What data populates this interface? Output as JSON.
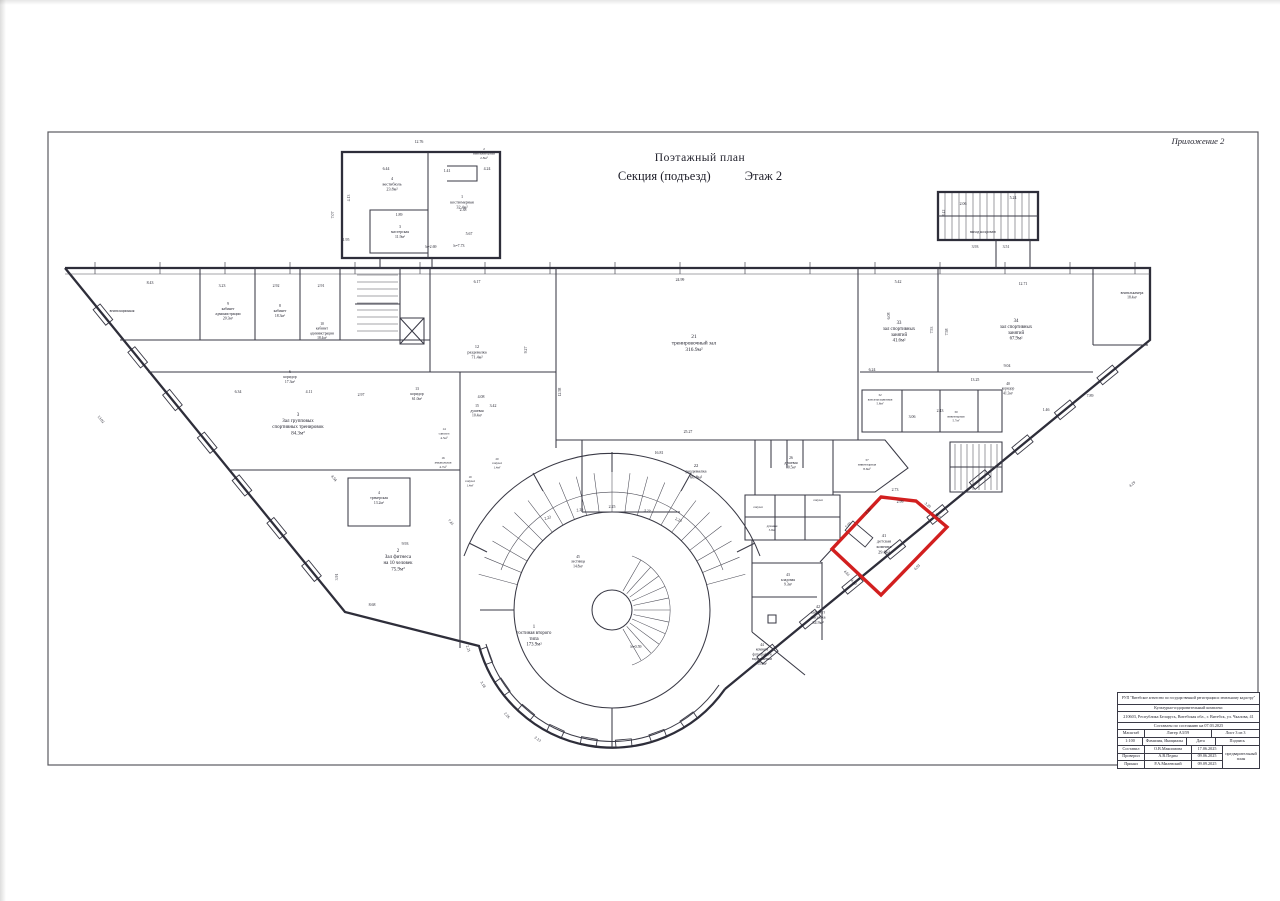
{
  "page": {
    "appendix": "Приложение 2",
    "title": "Поэтажный план",
    "subtitle": "Секция (подъезд)",
    "floor": "Этаж 2"
  },
  "plan": {
    "highlight_color": "#d21f1f",
    "rooms": [
      {
        "x": 392,
        "y": 180,
        "lines": [
          "4",
          "вестибюль",
          "23.8м²"
        ]
      },
      {
        "x": 484,
        "y": 150,
        "fs": 3.5,
        "lines": [
          "2",
          "вентиляторная",
          "2.8м²"
        ]
      },
      {
        "x": 462,
        "y": 198,
        "lines": [
          "1",
          "костюмерная",
          "32.4м²"
        ]
      },
      {
        "x": 400,
        "y": 228,
        "fs": 3.8,
        "lines": [
          "3",
          "мастерская",
          "11.9м²"
        ]
      },
      {
        "x": 122,
        "y": 312,
        "fs": 3.6,
        "lines": [
          "вентиляционная"
        ]
      },
      {
        "x": 228,
        "y": 305,
        "fs": 3.8,
        "lines": [
          "9",
          "кабинет",
          "администрации",
          "20.3м²"
        ]
      },
      {
        "x": 280,
        "y": 307,
        "fs": 3.8,
        "lines": [
          "8",
          "кабинет",
          "18.3м²"
        ]
      },
      {
        "x": 322,
        "y": 325,
        "fs": 3.6,
        "lines": [
          "10",
          "кабинет",
          "администрации",
          "18.4м²"
        ]
      },
      {
        "x": 477,
        "y": 348,
        "lines": [
          "12",
          "раздевалка",
          "71.4м²"
        ]
      },
      {
        "x": 290,
        "y": 373,
        "fs": 3.8,
        "lines": [
          "6",
          "коридор",
          "17.3м²"
        ]
      },
      {
        "x": 417,
        "y": 390,
        "fs": 3.8,
        "lines": [
          "13",
          "коридор",
          "61.0м²"
        ]
      },
      {
        "x": 298,
        "y": 416,
        "fs": 5,
        "lines": [
          "3",
          "Зал групповых",
          "спортивных тренировок",
          "84.3м²"
        ]
      },
      {
        "x": 477,
        "y": 407,
        "fs": 3.7,
        "lines": [
          "15",
          "душевая",
          "10.4м²"
        ]
      },
      {
        "x": 444,
        "y": 430,
        "fs": 3.3,
        "lines": [
          "14",
          "санузел",
          "4.5м²"
        ]
      },
      {
        "x": 443,
        "y": 459,
        "fs": 3.3,
        "lines": [
          "16",
          "умывальная",
          "4.7м²"
        ]
      },
      {
        "x": 470,
        "y": 478,
        "fs": 3.1,
        "lines": [
          "19",
          "санузел",
          "1.4м²"
        ]
      },
      {
        "x": 497,
        "y": 460,
        "fs": 3.1,
        "lines": [
          "20",
          "санузел",
          "1.4м²"
        ]
      },
      {
        "x": 379,
        "y": 494,
        "fs": 3.8,
        "lines": [
          "4",
          "тренерская",
          "13.2м²"
        ]
      },
      {
        "x": 398,
        "y": 552,
        "fs": 5,
        "lines": [
          "2",
          "Зал фитнеса",
          "на 10 человек",
          "75.9м²"
        ]
      },
      {
        "x": 694,
        "y": 338,
        "fs": 5.4,
        "lines": [
          "21",
          "тренировочный зал",
          "316.9м²"
        ]
      },
      {
        "x": 696,
        "y": 467,
        "fs": 4.6,
        "lines": [
          "22",
          "раздевалка",
          "60.8м²"
        ]
      },
      {
        "x": 791,
        "y": 459,
        "fs": 3.7,
        "lines": [
          "26",
          "душевая",
          "10.5м²"
        ]
      },
      {
        "x": 867,
        "y": 461,
        "fs": 3.4,
        "lines": [
          "37",
          "инвентарная",
          "8.6м²"
        ]
      },
      {
        "x": 758,
        "y": 508,
        "fs": 3,
        "lines": [
          "санузел"
        ]
      },
      {
        "x": 818,
        "y": 501,
        "fs": 3,
        "lines": [
          "санузел"
        ]
      },
      {
        "x": 772,
        "y": 527,
        "fs": 3,
        "lines": [
          "душевая",
          "3.9м²"
        ]
      },
      {
        "x": 880,
        "y": 396,
        "fs": 3.2,
        "lines": [
          "32",
          "консультационная",
          "5.8м²"
        ]
      },
      {
        "x": 956,
        "y": 413,
        "fs": 3.2,
        "lines": [
          "30",
          "инвентарная",
          "5.7м²"
        ]
      },
      {
        "x": 1008,
        "y": 385,
        "fs": 3.6,
        "lines": [
          "40",
          "коридор",
          "41.3м²"
        ]
      },
      {
        "x": 899,
        "y": 324,
        "fs": 4.8,
        "lines": [
          "33",
          "зал спортивных",
          "занятий",
          "41.6м²"
        ]
      },
      {
        "x": 1016,
        "y": 322,
        "fs": 4.8,
        "lines": [
          "34",
          "зал спортивных",
          "занятий",
          "67.9м²"
        ]
      },
      {
        "x": 1132,
        "y": 294,
        "fs": 3.6,
        "lines": [
          "вентилькамера",
          "18.4м²"
        ]
      },
      {
        "x": 983,
        "y": 233,
        "fs": 3.6,
        "lines": [
          "выход на кровлю"
        ]
      },
      {
        "x": 578,
        "y": 558,
        "fs": 3.6,
        "lines": [
          "45",
          "лестница",
          "14.8м²"
        ]
      },
      {
        "x": 534,
        "y": 628,
        "fs": 4.8,
        "lines": [
          "1",
          "гостиная второго",
          "типа",
          "173.9м²"
        ]
      },
      {
        "x": 884,
        "y": 537,
        "fs": 4.4,
        "lines": [
          "41",
          "детская",
          "комната",
          "29.0м²"
        ]
      },
      {
        "x": 818,
        "y": 608,
        "fs": 4.2,
        "lines": [
          "42",
          "кабинет",
          "массажа",
          "34.9м²"
        ]
      },
      {
        "x": 788,
        "y": 576,
        "fs": 3.7,
        "lines": [
          "43",
          "кладовая",
          "9.3м²"
        ]
      },
      {
        "x": 762,
        "y": 646,
        "fs": 3.6,
        "lines": [
          "44",
          "комната",
          "фотографа и",
          "видеосъемки",
          "15.9м²"
        ]
      }
    ],
    "dims": [
      [
        "12.76",
        419,
        143
      ],
      [
        "6.44",
        386,
        170
      ],
      [
        "4.24",
        487,
        170
      ],
      [
        "1.41",
        447,
        172
      ],
      [
        "2.38",
        463,
        211
      ],
      [
        "5.67",
        469,
        235
      ],
      [
        "h=7.73",
        459,
        247
      ],
      [
        "b=2.69",
        431,
        248
      ],
      [
        "1.95",
        346,
        241
      ],
      [
        "1.89",
        399,
        216
      ],
      [
        "4.13",
        350,
        198,
        -90
      ],
      [
        "7.07",
        334,
        215,
        -90
      ],
      [
        "8.42",
        945,
        213,
        -90
      ],
      [
        "5.24",
        1013,
        199
      ],
      [
        "2.06",
        963,
        205
      ],
      [
        "3.93",
        975,
        248
      ],
      [
        "3.51",
        1006,
        248
      ],
      [
        "8.43",
        150,
        284
      ],
      [
        "3.23",
        222,
        287
      ],
      [
        "2.92",
        276,
        287
      ],
      [
        "2.91",
        321,
        287
      ],
      [
        "6.17",
        477,
        283
      ],
      [
        "24.99",
        680,
        281
      ],
      [
        "5.42",
        898,
        283
      ],
      [
        "12.71",
        1023,
        285
      ],
      [
        "6.08",
        890,
        316,
        -90
      ],
      [
        "7.53",
        933,
        330,
        -90
      ],
      [
        "7.58",
        948,
        332,
        -90
      ],
      [
        "6.24",
        872,
        371
      ],
      [
        "9.04",
        1007,
        367
      ],
      [
        "13.25",
        975,
        381
      ],
      [
        "3.06",
        912,
        418
      ],
      [
        "2.43",
        940,
        412
      ],
      [
        "1.46",
        1046,
        411
      ],
      [
        "7.89",
        1090,
        397
      ],
      [
        "25.27",
        688,
        433
      ],
      [
        "16.81",
        659,
        454
      ],
      [
        "9.27",
        527,
        350,
        -90
      ],
      [
        "12.58",
        561,
        392,
        -90
      ],
      [
        "4.08",
        481,
        398
      ],
      [
        "3.42",
        493,
        407
      ],
      [
        "13.02",
        100,
        420,
        51
      ],
      [
        "6.34",
        238,
        393
      ],
      [
        "4.11",
        309,
        393
      ],
      [
        "2.97",
        361,
        396
      ],
      [
        "8.68",
        372,
        606
      ],
      [
        "3.91",
        338,
        577,
        -90
      ],
      [
        "4.54",
        333,
        479,
        51
      ],
      [
        "9.93",
        405,
        545
      ],
      [
        "7.41",
        450,
        523,
        45
      ],
      [
        "2.73",
        895,
        491
      ],
      [
        "2.99",
        900,
        503
      ],
      [
        "3.20",
        927,
        506,
        40
      ],
      [
        "3.05",
        937,
        517,
        40
      ],
      [
        "6.93",
        918,
        568,
        -45
      ],
      [
        "4.80",
        853,
        583,
        45
      ],
      [
        "4.61",
        846,
        574,
        45
      ],
      [
        "7.00",
        849,
        526,
        -46
      ],
      [
        "2.80",
        869,
        512,
        -46
      ],
      [
        "4.29",
        1133,
        485,
        -40
      ],
      [
        "2.22",
        548,
        519,
        -18
      ],
      [
        "2.26",
        580,
        511,
        -8
      ],
      [
        "2.25",
        612,
        508
      ],
      [
        "3.27",
        647,
        512,
        10
      ],
      [
        "2.23",
        678,
        521,
        22
      ],
      [
        "2.21",
        467,
        649,
        72
      ],
      [
        "3.18",
        482,
        685,
        60
      ],
      [
        "2.26",
        506,
        716,
        48
      ],
      [
        "2.13",
        537,
        740,
        35
      ],
      [
        "h=0.59",
        636,
        648
      ]
    ]
  },
  "stamp": {
    "org": "РУП \"Витебское агентство по государственной регистрации и земельному кадастру\"",
    "complex": "Культурно-оздоровительный комплекс",
    "address": "210603, Республика Беларусь, Витебская обл., г. Витебск, ул. Чкалова, 41",
    "asof": "Составлен по состоянию на 07.03.2025",
    "scale_label": "Масштаб",
    "liter": "Литер   А3/59",
    "sheet": "Лист 3 из 3",
    "scale": "1:100",
    "fio_header": "Фамилия, Инициалы",
    "date_header": "Дата",
    "sign_header": "Подпись",
    "note": "предварительный план",
    "rows": [
      {
        "role": "Составил",
        "name": "О.В.Максимова",
        "date": "17.06.2025"
      },
      {
        "role": "Проверил",
        "name": "А.В.Педин",
        "date": "09.06.2025"
      },
      {
        "role": "Принял",
        "name": "Р.А.Милевский",
        "date": "09.09.2025"
      }
    ]
  }
}
